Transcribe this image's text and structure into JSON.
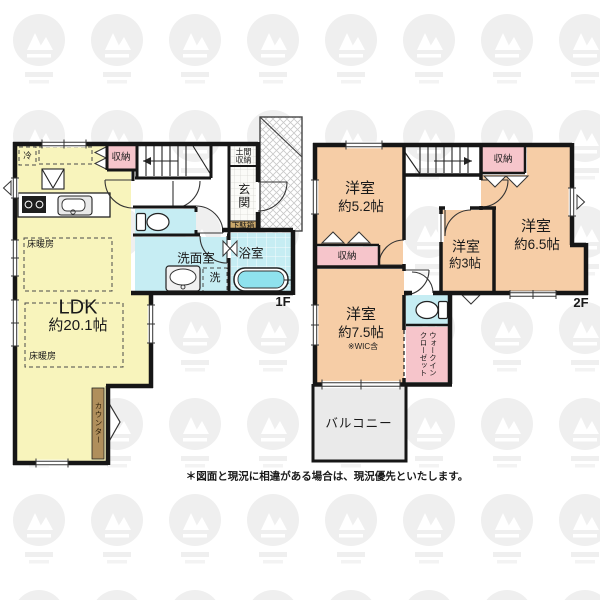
{
  "floor_1f": {
    "floor_label": "1F",
    "ldk": {
      "name": "LDK",
      "size": "約20.1帖"
    },
    "floor_heating_label_1": "床暖房",
    "floor_heating_label_2": "床暖房",
    "refrigerator_label": "冷",
    "storage_label": "収納",
    "doma_storage_label": "土間収納",
    "entrance_label": "玄関",
    "shoe_cabinet_label": "下駄箱",
    "washroom_label": "洗面室",
    "washer_label": "洗",
    "bathroom_label": "浴室",
    "counter_label": "カウンター"
  },
  "floor_2f": {
    "floor_label": "2F",
    "bedroom_52": {
      "name": "洋室",
      "size": "約5.2帖"
    },
    "bedroom_65": {
      "name": "洋室",
      "size": "約6.5帖"
    },
    "bedroom_3": {
      "name": "洋室",
      "size": "約3帖"
    },
    "bedroom_75": {
      "name": "洋室",
      "size": "約7.5帖",
      "note": "※WIC含"
    },
    "storage_label_left": "収納",
    "storage_label_right": "収納",
    "wic_label_line1": "ウォークイン",
    "wic_label_line2": "クローゼット",
    "balcony_label": "バルコニー"
  },
  "footer": {
    "disclaimer": "＊図面と現況に相違がある場合は、現況優先といたします。"
  },
  "colors": {
    "ldk_floor": "#F8F4BC",
    "bedroom_floor": "#F6CDA6",
    "storage_pink": "#F6C5CB",
    "wet_area_blue": "#C6EDF3",
    "tub_water": "#8FE2EE",
    "counter_brown": "#B08F5C",
    "shoebox_tan": "#C9A76B",
    "balcony_gray": "#EAEAEA",
    "wall": "#1A1A1A"
  }
}
